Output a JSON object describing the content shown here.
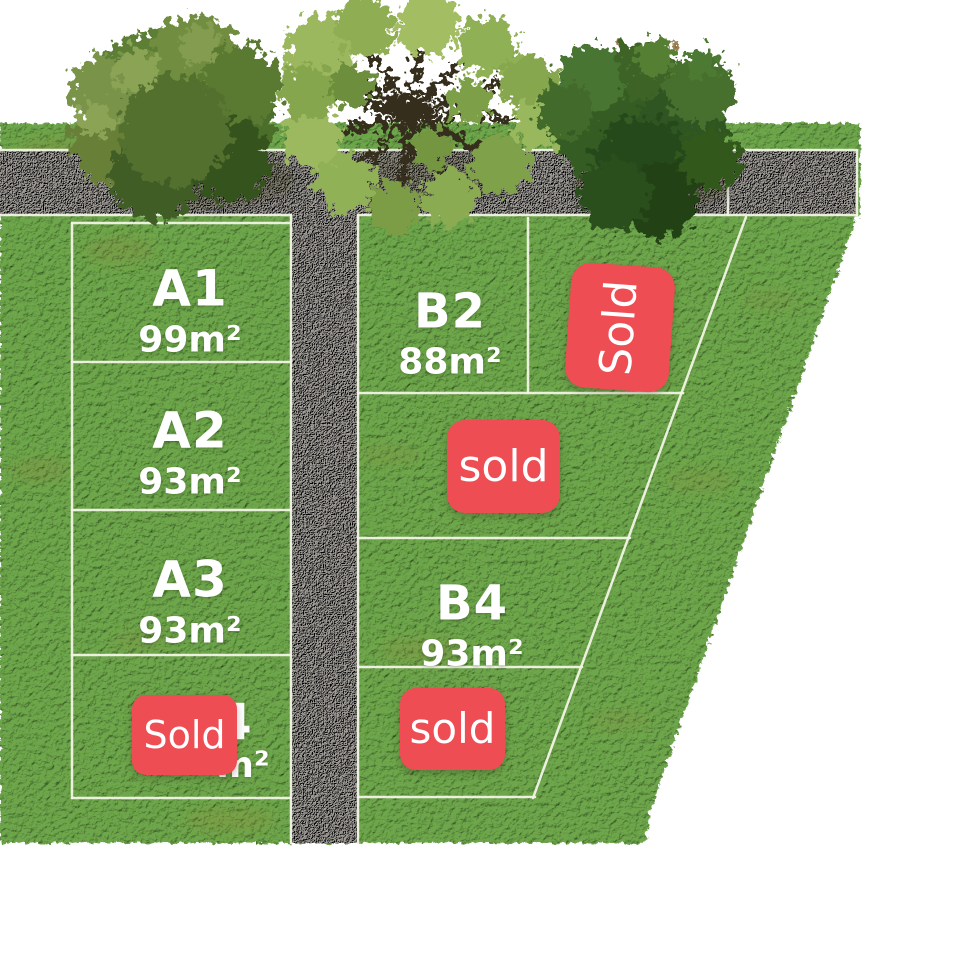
{
  "plots": [
    {
      "id": "A1",
      "area": "99m²",
      "badge": ""
    },
    {
      "id": "A2",
      "area": "93m²",
      "badge": ""
    },
    {
      "id": "A3",
      "area": "93m²",
      "badge": ""
    },
    {
      "id": "A4",
      "area": "m²",
      "badge": "Sold"
    },
    {
      "id": "B2",
      "area": "88m²",
      "badge": ""
    },
    {
      "id": "B4",
      "area": "93m²",
      "badge": ""
    },
    {
      "id": "",
      "area": "",
      "badge": "Sold"
    },
    {
      "id": "",
      "area": "",
      "badge": "sold"
    },
    {
      "id": "",
      "area": "",
      "badge": "sold"
    }
  ],
  "colors": {
    "background": "#ffffff",
    "grass": "#5c8f3e",
    "road_gravel": "#8a8781",
    "boundary_line": "#f2f4e6",
    "sold_badge": "#ef4d54",
    "badge_text": "#ffffff",
    "label_text": "#ffffff"
  }
}
